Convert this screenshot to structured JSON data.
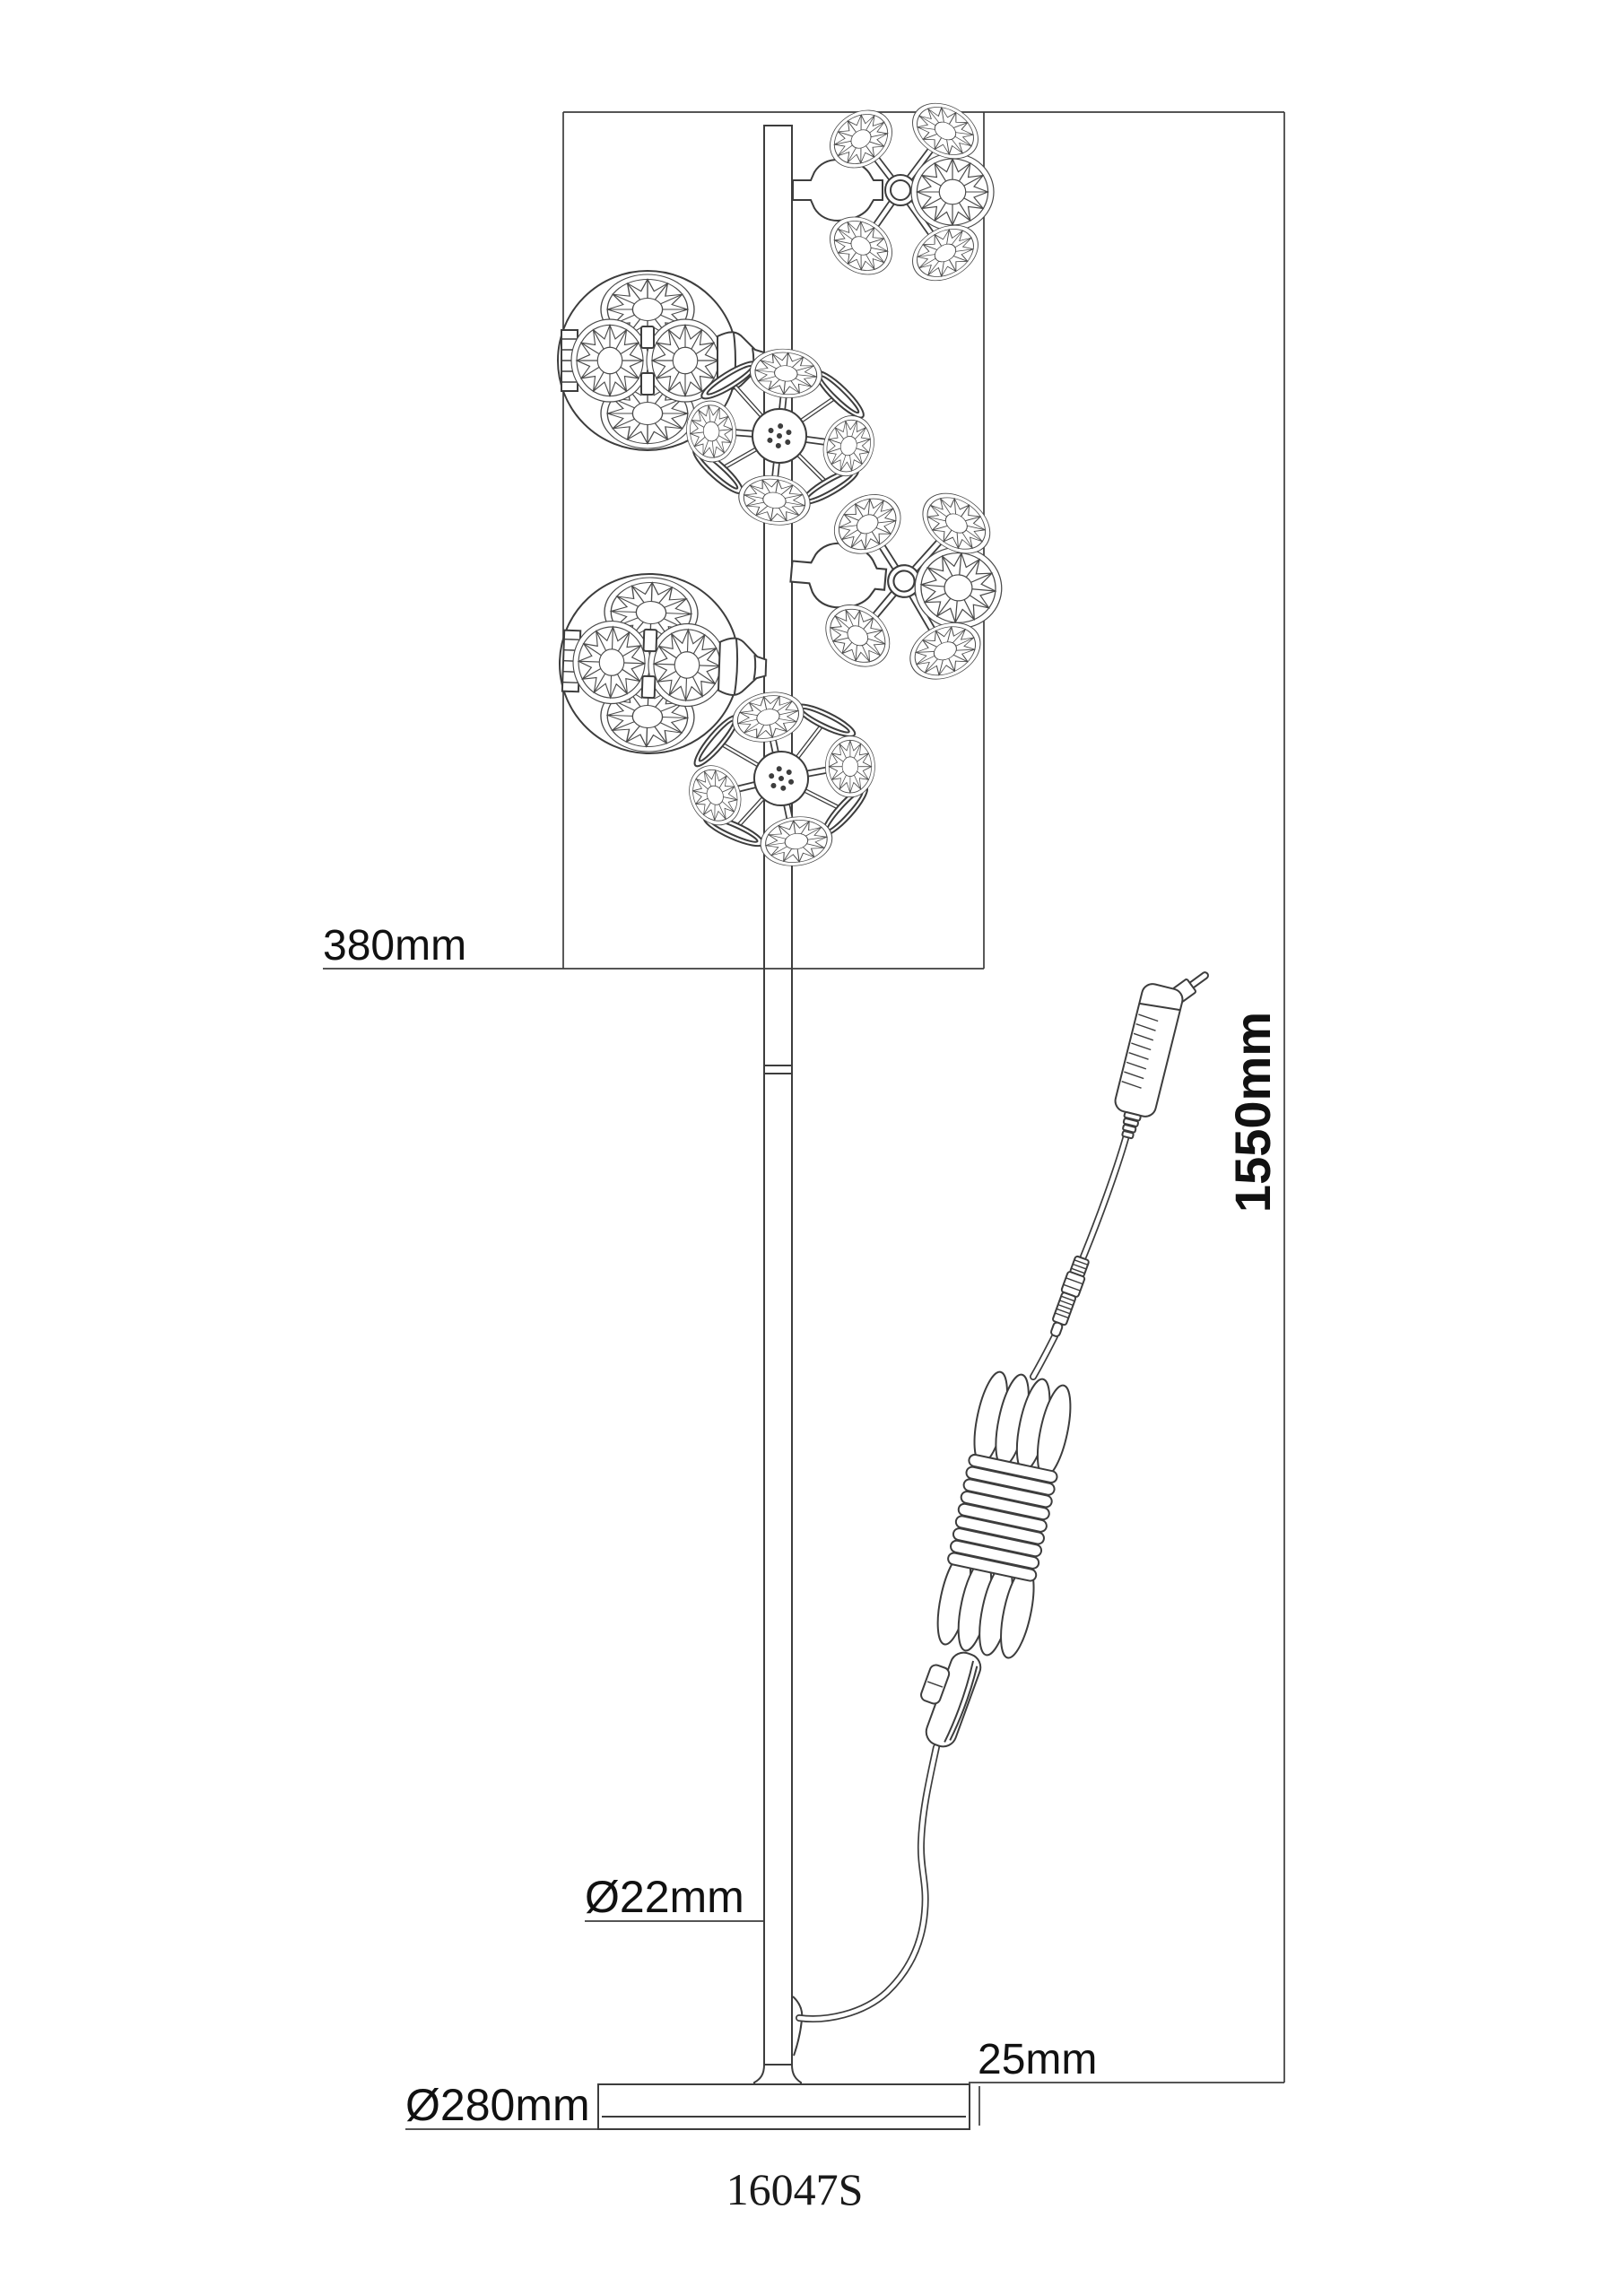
{
  "drawing": {
    "model": "16047S",
    "dimensions": {
      "shade_cluster_width": "380mm",
      "total_height": "1550mm",
      "pole_diameter": "Ø22mm",
      "base_height": "25mm",
      "base_diameter": "Ø280mm"
    },
    "colors": {
      "line": "#3d3d3d",
      "background": "#ffffff",
      "text": "#111111"
    },
    "parts": {
      "pole": "vertical pole",
      "base": "round base plate",
      "shades": [
        "crystal dandelion side view top",
        "crystal ball upper",
        "crystal dandelion front upper",
        "crystal dandelion side view right",
        "crystal ball lower",
        "crystal dandelion front lower"
      ],
      "cord": [
        "power plug",
        "inline connector",
        "coiled cord bundle",
        "rocker switch"
      ]
    }
  }
}
